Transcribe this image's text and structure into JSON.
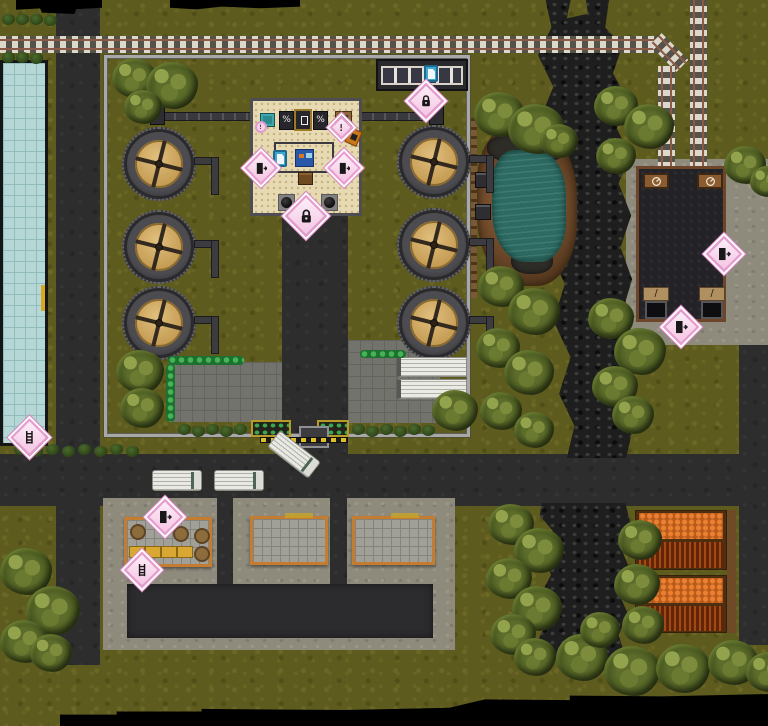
{
  "meta": {
    "scene": "top-down industrial water-treatment compound map",
    "width": 768,
    "height": 726
  },
  "palette": {
    "grass": "#5d5b1e",
    "road": "#2d2d2d",
    "rock_creek": "#1d1e1d",
    "pool_water": "#b5d7d6",
    "pond_water": "#2c6a62",
    "rail_tie": "#ddd8cc",
    "rail_steel": "#8a5a46",
    "compound_wall": "#a8a8a8",
    "tank_lid": "#c49b52",
    "office_floor": "#e7dab2",
    "marker_pink": "#e89cd0",
    "platform_orange": "#c47c30",
    "crop_ripe": "#ea8030",
    "crop_rows": "#7e3010",
    "tree_canopy": "#5c6c2a",
    "void": "#000000"
  },
  "markers": [
    {
      "id": "office-entrance-lock",
      "icon": "lock-icon",
      "x": 306,
      "y": 216,
      "s": 30
    },
    {
      "id": "shed-lock",
      "icon": "lock-icon",
      "x": 426,
      "y": 101,
      "s": 26
    },
    {
      "id": "office-west-door",
      "icon": "exit-door-icon",
      "x": 261,
      "y": 168,
      "s": 24
    },
    {
      "id": "office-east-door",
      "icon": "exit-door-icon",
      "x": 344,
      "y": 168,
      "s": 24
    },
    {
      "id": "office-alert",
      "icon": "alert-icon",
      "x": 341,
      "y": 127,
      "s": 17
    },
    {
      "id": "office-round-badge",
      "icon": "alert-icon",
      "x": 261,
      "y": 127,
      "s": 12,
      "shape": "circle"
    },
    {
      "id": "depot-east-door",
      "icon": "exit-door-icon",
      "x": 724,
      "y": 254,
      "s": 26
    },
    {
      "id": "depot-south-door",
      "icon": "exit-door-icon",
      "x": 681,
      "y": 327,
      "s": 26
    },
    {
      "id": "dock-north-door",
      "icon": "exit-door-icon",
      "x": 165,
      "y": 517,
      "s": 26
    },
    {
      "id": "dock-ladder",
      "icon": "ladder-icon",
      "x": 142,
      "y": 570,
      "s": 26
    },
    {
      "id": "pool-ladder-marker",
      "icon": "ladder-icon",
      "x": 29,
      "y": 437,
      "s": 27
    }
  ],
  "doc_signs": [
    {
      "id": "shed-document-sign",
      "x": 424,
      "y": 65
    },
    {
      "id": "office-document-sign",
      "x": 273,
      "y": 150
    }
  ],
  "sprites": {
    "tanks": [
      {
        "x": 122,
        "y": 127
      },
      {
        "x": 122,
        "y": 210
      },
      {
        "x": 122,
        "y": 286
      },
      {
        "x": 397,
        "y": 125
      },
      {
        "x": 397,
        "y": 208
      },
      {
        "x": 397,
        "y": 286
      }
    ],
    "trucks": [
      {
        "x": 152,
        "y": 470,
        "w": 50,
        "h": 21,
        "rot": 0
      },
      {
        "x": 214,
        "y": 470,
        "w": 50,
        "h": 21,
        "rot": 0
      },
      {
        "x": 268,
        "y": 444,
        "w": 52,
        "h": 21,
        "rot": 38
      }
    ],
    "trailers": [
      {
        "x": 397,
        "y": 357
      },
      {
        "x": 397,
        "y": 379
      }
    ],
    "trees": [
      {
        "x": 112,
        "y": 58,
        "s": 44
      },
      {
        "x": 146,
        "y": 62,
        "s": 52
      },
      {
        "x": 124,
        "y": 90,
        "s": 38
      },
      {
        "x": 116,
        "y": 350,
        "s": 48
      },
      {
        "x": 120,
        "y": 388,
        "s": 44
      },
      {
        "x": 432,
        "y": 390,
        "s": 46
      },
      {
        "x": 474,
        "y": 92,
        "s": 50
      },
      {
        "x": 508,
        "y": 104,
        "s": 56
      },
      {
        "x": 540,
        "y": 124,
        "s": 38
      },
      {
        "x": 478,
        "y": 266,
        "s": 46
      },
      {
        "x": 508,
        "y": 288,
        "s": 52
      },
      {
        "x": 476,
        "y": 328,
        "s": 44
      },
      {
        "x": 504,
        "y": 350,
        "s": 50
      },
      {
        "x": 480,
        "y": 392,
        "s": 42
      },
      {
        "x": 514,
        "y": 412,
        "s": 40
      },
      {
        "x": 594,
        "y": 86,
        "s": 44
      },
      {
        "x": 624,
        "y": 104,
        "s": 50
      },
      {
        "x": 596,
        "y": 138,
        "s": 40
      },
      {
        "x": 588,
        "y": 298,
        "s": 46
      },
      {
        "x": 614,
        "y": 328,
        "s": 52
      },
      {
        "x": 592,
        "y": 366,
        "s": 46
      },
      {
        "x": 612,
        "y": 396,
        "s": 42
      },
      {
        "x": 724,
        "y": 146,
        "s": 42
      },
      {
        "x": 750,
        "y": 166,
        "s": 34
      },
      {
        "x": 0,
        "y": 548,
        "s": 52
      },
      {
        "x": 26,
        "y": 586,
        "s": 54
      },
      {
        "x": 0,
        "y": 620,
        "s": 48
      },
      {
        "x": 30,
        "y": 634,
        "s": 42
      },
      {
        "x": 488,
        "y": 504,
        "s": 46
      },
      {
        "x": 514,
        "y": 528,
        "s": 50
      },
      {
        "x": 486,
        "y": 558,
        "s": 46
      },
      {
        "x": 512,
        "y": 586,
        "s": 50
      },
      {
        "x": 490,
        "y": 614,
        "s": 46
      },
      {
        "x": 514,
        "y": 638,
        "s": 42
      },
      {
        "x": 618,
        "y": 520,
        "s": 44
      },
      {
        "x": 614,
        "y": 564,
        "s": 46
      },
      {
        "x": 622,
        "y": 606,
        "s": 42
      },
      {
        "x": 556,
        "y": 634,
        "s": 52
      },
      {
        "x": 604,
        "y": 646,
        "s": 56
      },
      {
        "x": 656,
        "y": 644,
        "s": 54
      },
      {
        "x": 708,
        "y": 640,
        "s": 50
      },
      {
        "x": 746,
        "y": 652,
        "s": 44
      },
      {
        "x": 580,
        "y": 612,
        "s": 40
      }
    ],
    "bushes": [
      {
        "x": 2,
        "y": 14
      },
      {
        "x": 16,
        "y": 14
      },
      {
        "x": 30,
        "y": 14
      },
      {
        "x": 44,
        "y": 15
      },
      {
        "x": 2,
        "y": 52
      },
      {
        "x": 16,
        "y": 52
      },
      {
        "x": 30,
        "y": 53
      },
      {
        "x": 14,
        "y": 444
      },
      {
        "x": 30,
        "y": 446
      },
      {
        "x": 46,
        "y": 444
      },
      {
        "x": 62,
        "y": 446
      },
      {
        "x": 78,
        "y": 444
      },
      {
        "x": 94,
        "y": 446
      },
      {
        "x": 110,
        "y": 444
      },
      {
        "x": 126,
        "y": 446
      },
      {
        "x": 178,
        "y": 424
      },
      {
        "x": 192,
        "y": 426
      },
      {
        "x": 206,
        "y": 424
      },
      {
        "x": 220,
        "y": 426
      },
      {
        "x": 234,
        "y": 424
      },
      {
        "x": 352,
        "y": 424
      },
      {
        "x": 366,
        "y": 426
      },
      {
        "x": 380,
        "y": 424
      },
      {
        "x": 394,
        "y": 426
      },
      {
        "x": 408,
        "y": 424
      },
      {
        "x": 422,
        "y": 425
      }
    ]
  }
}
